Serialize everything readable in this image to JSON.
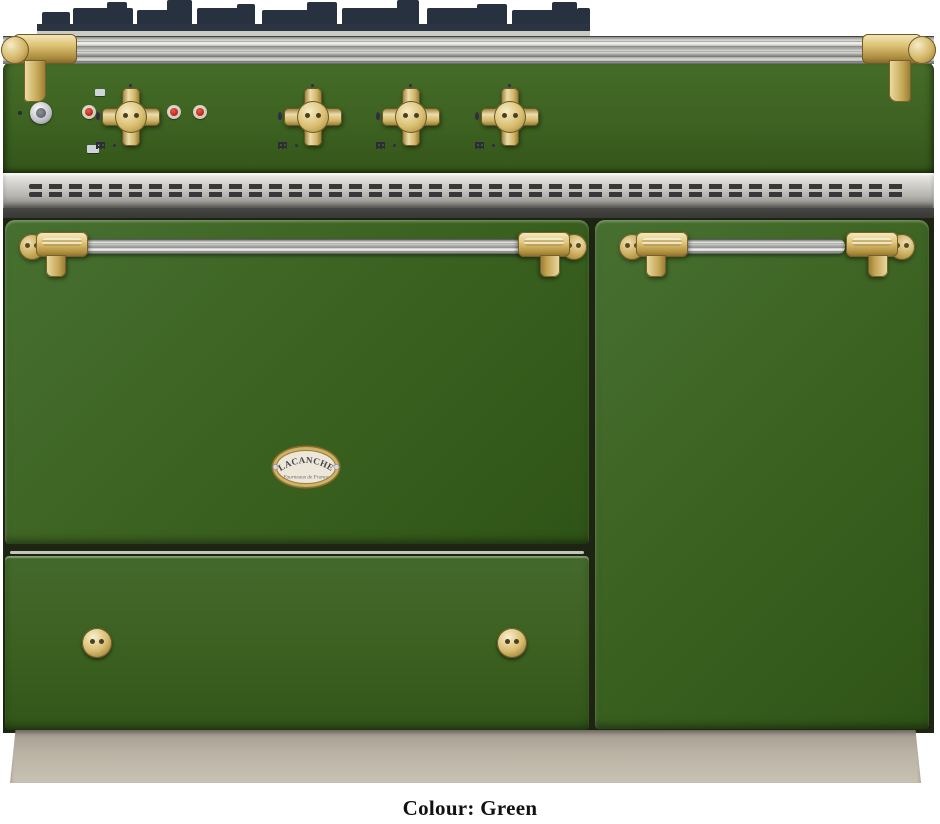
{
  "product": {
    "badge": {
      "brand": "LACANCHE",
      "tagline": "Fourneaux de France"
    },
    "caption": "Colour: Green"
  },
  "colors": {
    "body_green": "#3d6222",
    "body_green_dark": "#2e5316",
    "brass": "#d8bd6e",
    "chrome": "#d9d9d6",
    "grate_dark": "#273140",
    "vent_silver": "#c8c6c1",
    "dark_band": "#3a3a38",
    "plinth_taupe": "#b9b1a3",
    "pilot_red": "#b52718",
    "badge_face": "#ece7d8",
    "badge_rim": "#b99a4e",
    "background": "#ffffff"
  },
  "cooktop": {
    "burner_knob_count": 4,
    "pilot_light_count": 3,
    "oven_door_count": 2,
    "drawer_knob_count": 2
  }
}
